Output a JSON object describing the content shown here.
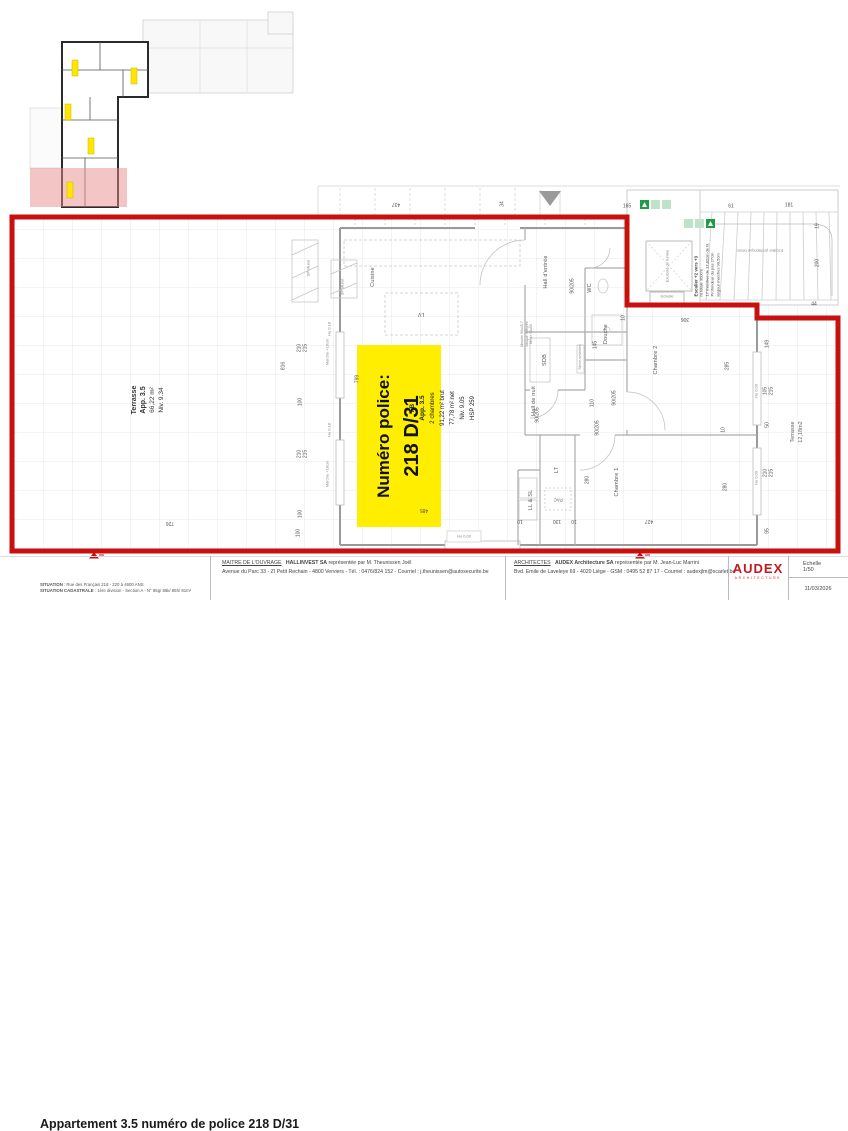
{
  "colors": {
    "boundary_red": "#c8100e",
    "police_yellow": "#ffee00",
    "exit_green": "#1f9d44",
    "audex_red": "#c41722"
  },
  "police_label": {
    "line1": "Numéro police:",
    "line2": "218 D/31"
  },
  "apt_info": [
    "I.B",
    "App. 3.5",
    "2 chambres",
    "91,22 m² brut",
    "77,78 m² net",
    "Niv. 9.05",
    "HSP 259"
  ],
  "terrace_left": [
    "Terrasse",
    "App. 3.5",
    "66,22 m²",
    "Niv. 9.34"
  ],
  "terrace_right": [
    "Terrasse",
    "12,18m2"
  ],
  "rooms": {
    "cuisine": "Cuisine",
    "lv": "LV",
    "hall_entree": "Hall d'entrée",
    "wc": "WC",
    "douche": "Douche",
    "sdb": "SDB",
    "hall_nuit": "Hall de nuit",
    "chambre1": "Chambre 1",
    "chambre2": "Chambre 2",
    "lt": "LT",
    "ll_sl": "LL & SL",
    "pac": "PAC"
  },
  "stairs": {
    "title": "Escalier +2 vers +3",
    "lines": [
      "ht totale 300cm",
      "17 marches de 17,82cm de ht",
      "Profondeur du pas 27cm",
      "largeur marches 90,5cm"
    ],
    "precast": "Escalier préfabriqué béton",
    "vent": "Exutoire de fumée",
    "echelle": "Echelle"
  },
  "annotations": {
    "hu018": "Hu 0.18",
    "hu000": "Hu 0.00",
    "marche": "Marche +18cm",
    "sp_muret": "SP Muret",
    "seche": "Sèche-serviettes"
  },
  "sdb_note": [
    "Meuble 90x45,7",
    "vasque intégrée",
    "Miroir 90x65"
  ],
  "dims": [
    {
      "t": "816",
      "x": 284,
      "y": 366,
      "r": 90
    },
    {
      "t": "210\n215",
      "x": 303,
      "y": 348,
      "r": 90
    },
    {
      "t": "100",
      "x": 301,
      "y": 402,
      "r": 90
    },
    {
      "t": "210\n215",
      "x": 303,
      "y": 454,
      "r": 90
    },
    {
      "t": "100",
      "x": 301,
      "y": 514,
      "r": 90
    },
    {
      "t": "100",
      "x": 299,
      "y": 533,
      "r": 90
    },
    {
      "t": "799",
      "x": 358,
      "y": 379,
      "r": 90
    },
    {
      "t": "726",
      "x": 170,
      "y": 522,
      "r": 180
    },
    {
      "t": "437",
      "x": 396,
      "y": 203,
      "r": 180
    },
    {
      "t": "34",
      "x": 503,
      "y": 204,
      "r": 90
    },
    {
      "t": "165",
      "x": 627,
      "y": 207,
      "r": 0
    },
    {
      "t": "61",
      "x": 731,
      "y": 207,
      "r": 0
    },
    {
      "t": "181",
      "x": 789,
      "y": 206,
      "r": 0
    },
    {
      "t": "19",
      "x": 818,
      "y": 226,
      "r": 90
    },
    {
      "t": "200",
      "x": 818,
      "y": 263,
      "r": 90
    },
    {
      "t": "44",
      "x": 814,
      "y": 305,
      "r": 0
    },
    {
      "t": "149",
      "x": 768,
      "y": 344,
      "r": 90
    },
    {
      "t": "105\n215",
      "x": 769,
      "y": 391,
      "r": 90
    },
    {
      "t": "50",
      "x": 768,
      "y": 425,
      "r": 90
    },
    {
      "t": "210\n215",
      "x": 769,
      "y": 473,
      "r": 90
    },
    {
      "t": "95",
      "x": 768,
      "y": 531,
      "r": 90
    },
    {
      "t": "285",
      "x": 728,
      "y": 366,
      "r": 90
    },
    {
      "t": "10",
      "x": 724,
      "y": 430,
      "r": 90
    },
    {
      "t": "280",
      "x": 726,
      "y": 487,
      "r": 90
    },
    {
      "t": "306",
      "x": 685,
      "y": 318,
      "r": 180
    },
    {
      "t": "10",
      "x": 624,
      "y": 318,
      "r": 90
    },
    {
      "t": "90/205",
      "x": 573,
      "y": 286,
      "r": 90
    },
    {
      "t": "145",
      "x": 596,
      "y": 345,
      "r": 90
    },
    {
      "t": "90/205",
      "x": 615,
      "y": 398,
      "r": 90
    },
    {
      "t": "110",
      "x": 593,
      "y": 403,
      "r": 90
    },
    {
      "t": "90/205",
      "x": 538,
      "y": 415,
      "r": 90
    },
    {
      "t": "90/205",
      "x": 598,
      "y": 428,
      "r": 90
    },
    {
      "t": "280",
      "x": 588,
      "y": 480,
      "r": 90
    },
    {
      "t": "485",
      "x": 424,
      "y": 509,
      "r": 180
    },
    {
      "t": "10",
      "x": 520,
      "y": 520,
      "r": 180
    },
    {
      "t": "130",
      "x": 557,
      "y": 520,
      "r": 180
    },
    {
      "t": "10",
      "x": 574,
      "y": 520,
      "r": 180
    },
    {
      "t": "427",
      "x": 649,
      "y": 520,
      "r": 180
    }
  ],
  "titleblock": {
    "title": "Appartement 3.5 numéro de police 218 D/31",
    "situation_label": "SITUATION",
    "situation": " : Rue des Français 218 - 220 à 4600 ANS",
    "cadastrale_label": "SITUATION CADASTRALE",
    "cadastrale": " : 1ère division - Section A - N° 85g/ 85k/ 85h/ 81m²",
    "maitre_label": "MAITRE DE L'OUVRAGE",
    "maitre_name": "HALLINVEST SA",
    "maitre_rest": " représentée par M. Theunissen Joël",
    "maitre_addr": "Avenue du Parc 33 - ZI Petit Rechain - 4800 Verviers - Tél. : 0476/824 152 - Courriel : j.theunissen@autosecurite.be",
    "arch_label": "ARCHITECTES",
    "arch_name": "AUDEX Architecture SA",
    "arch_rest": " représentée par M. Jean-Luc Marrini",
    "arch_addr": "Bvd. Emile de Laveleye 69 - 4020 Liège - GSM : 0495 52 87 17 - Courriel : audexjlm@scarlet.be",
    "logo": "AUDEX",
    "logo_sub": "ARCHITECTURE",
    "echelle": "Echelle 1/50",
    "date": "11/03/2026"
  }
}
